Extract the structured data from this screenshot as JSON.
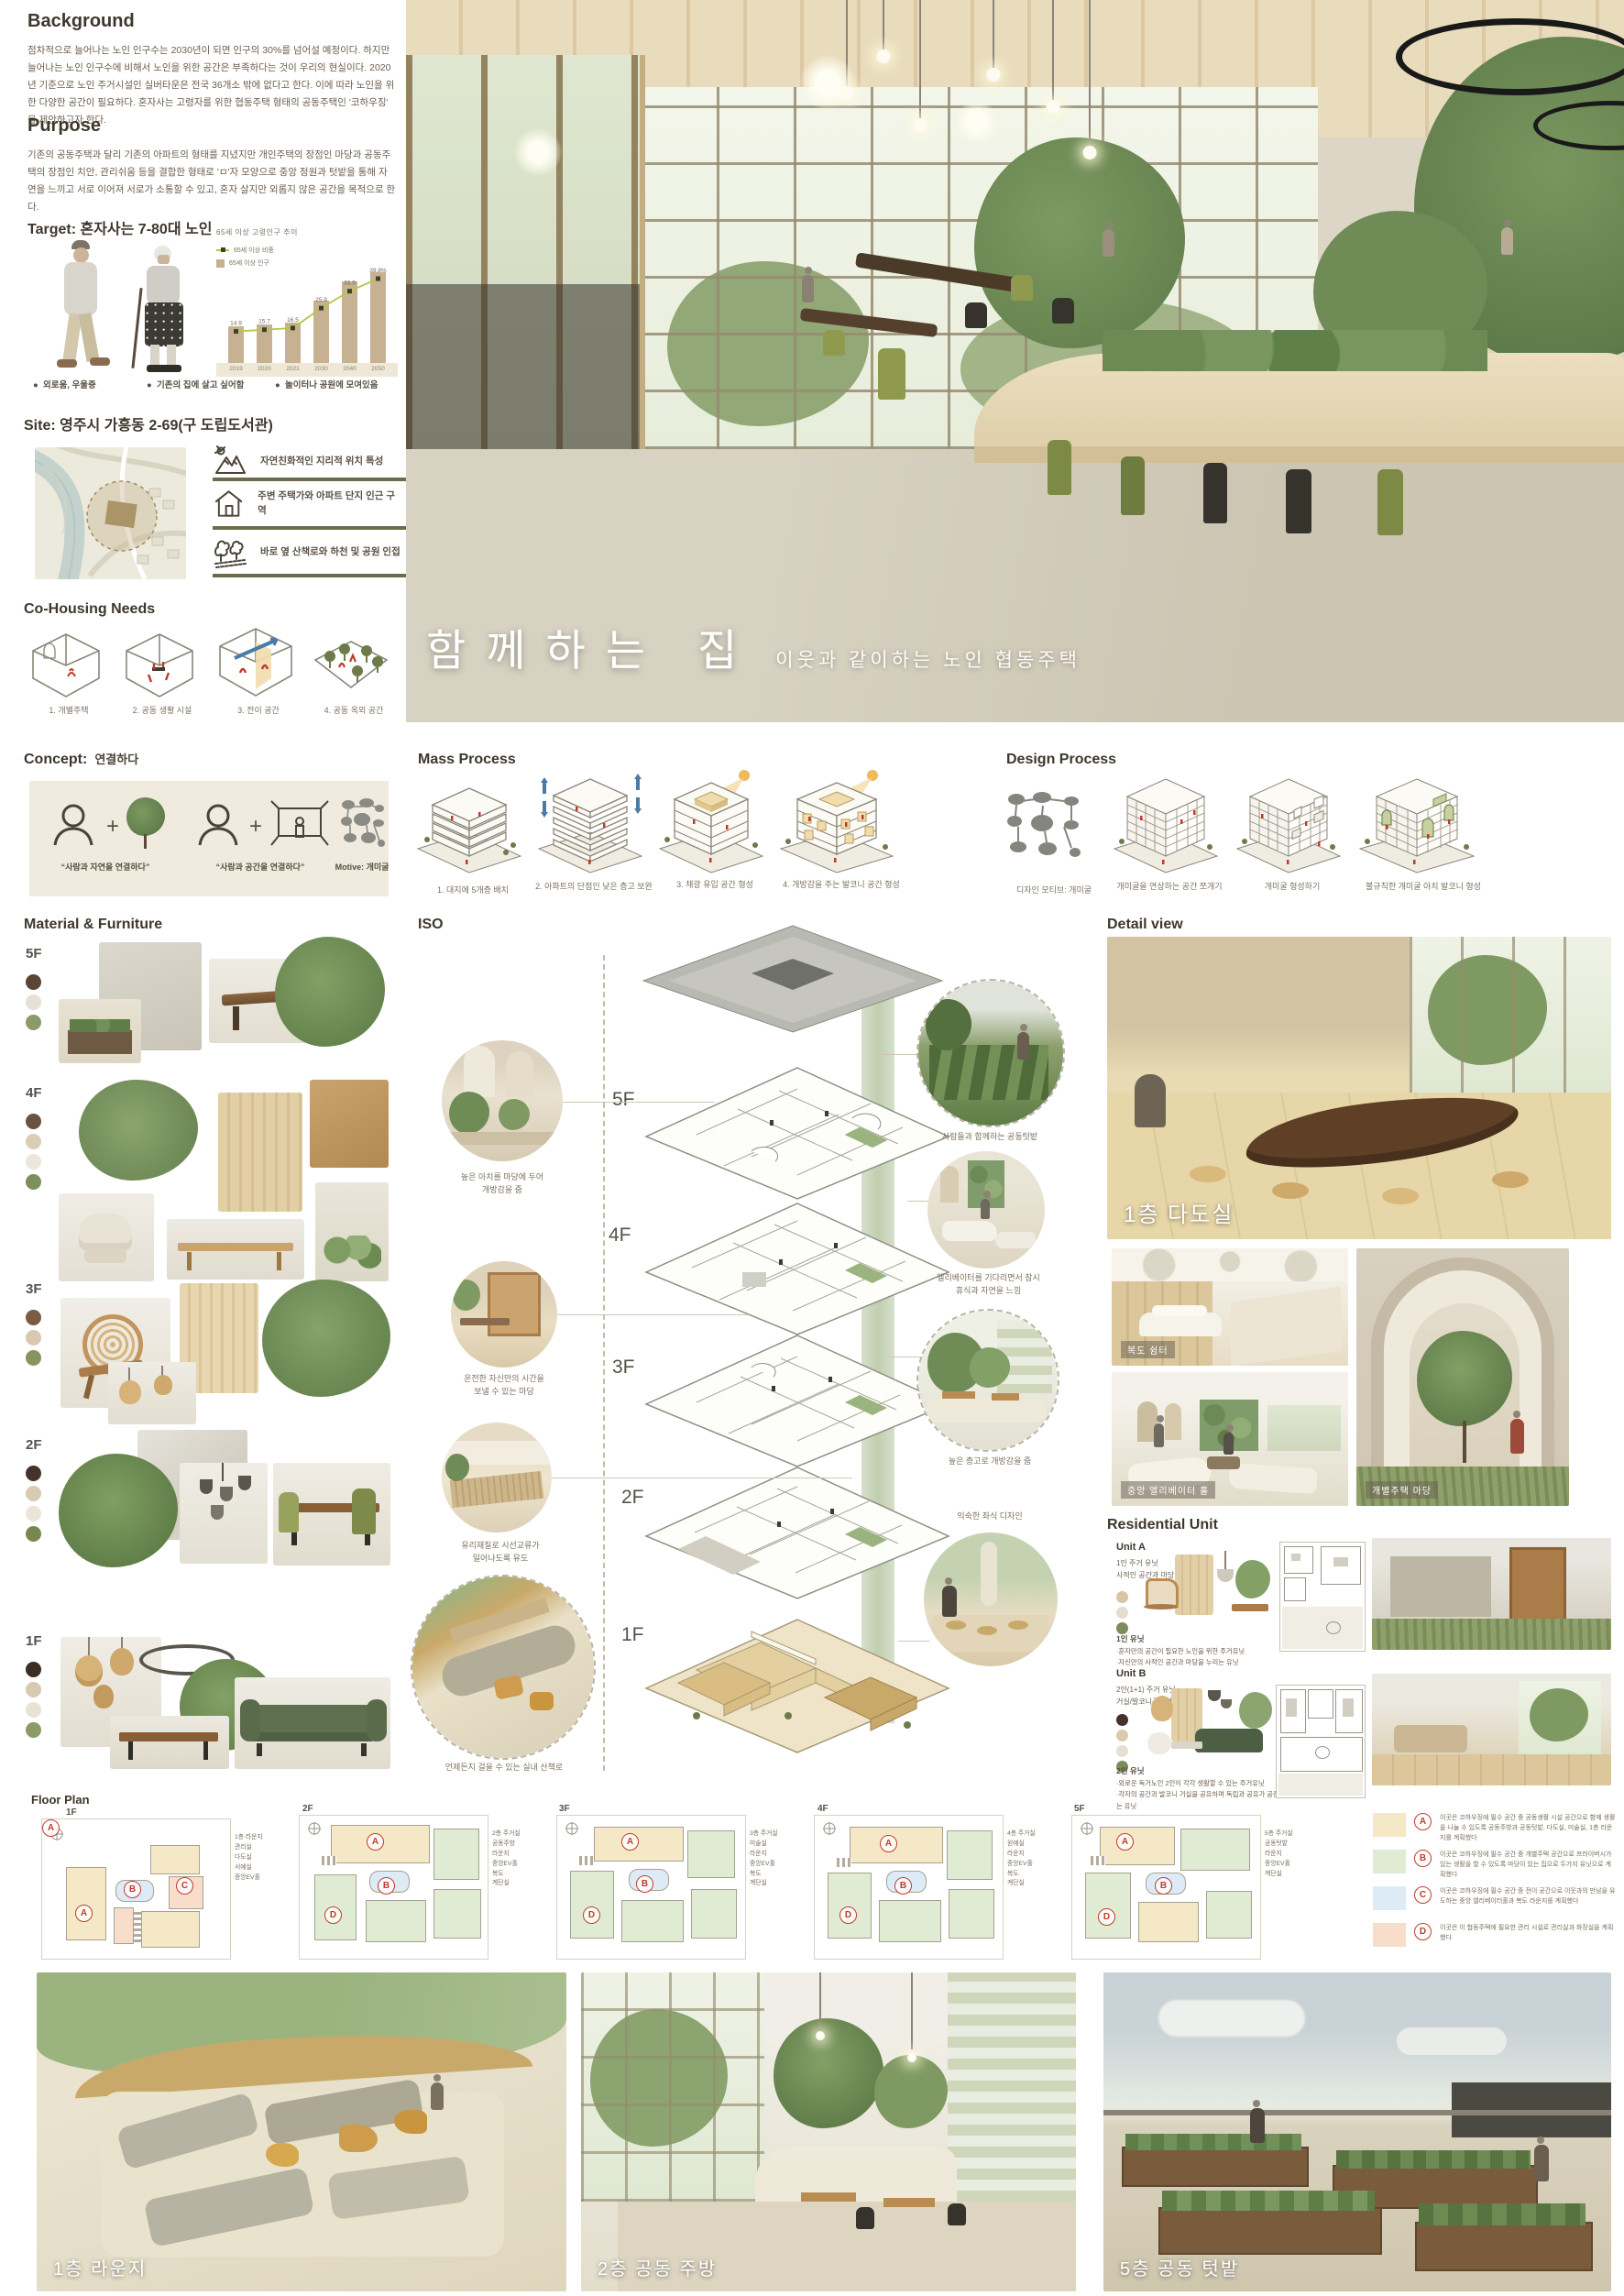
{
  "poster": {
    "title_main": "함께하는 집",
    "title_sub": "이웃과 같이하는 노인 협동주택"
  },
  "background": {
    "heading": "Background",
    "body": "점차적으로 늘어나는 노인 인구수는 2030년이 되면 인구의 30%를 넘어설 예정이다. 하지만 늘어나는 노인 인구수에 비해서 노인을 위한 공간은 부족하다는 것이 우리의 현실이다. 2020년 기준으로 노인 주거시설인 실버타운은 전국 36개소 밖에 없다고 한다. 이에 따라 노인을 위한 다양한 공간이 필요하다. 혼자사는 고령자를 위한 협동주택 형태의 공동주택인 '코하우징' 을 제안하고자 한다."
  },
  "purpose": {
    "heading": "Purpose",
    "body": "기존의 공동주택과 달리 기존의 아파트의 형태를 지녔지만 개인주택의 장점인 마당과 공동주택의 장점인 치안, 관리쉬움 등을 결합한 형태로 'ㅁ'자 모양으로 중앙 정원과 텃밭을 통해 자연을 느끼고 서로 이어져 서로가 소통할 수 있고, 혼자 살지만 외롭지 않은 공간을 목적으로 한다."
  },
  "target": {
    "heading": "Target: 혼자사는 7-80대 노인",
    "bullets": [
      "외로움, 우울증",
      "기존의 집에 살고 싶어함",
      "놀이터나 공원에 모여있음"
    ]
  },
  "chart_data": {
    "type": "bar",
    "title": "65세 이상 고령인구 추이",
    "categories": [
      "2019",
      "2020",
      "2021",
      "2030",
      "2040",
      "2050"
    ],
    "series": [
      {
        "name": "65세 이상 비중",
        "type": "line",
        "values": [
          14.9,
          15.7,
          16.5,
          25.9,
          33.9,
          39.8
        ],
        "point_labels": [
          "14.9",
          "15.7",
          "16.5",
          "25.9",
          "33.9",
          "39.8%"
        ]
      },
      {
        "name": "65세 이상 인구",
        "type": "bar",
        "values": [
          770,
          810,
          850,
          1300,
          1720,
          1900
        ]
      }
    ],
    "xlabel": "",
    "ylabel": "",
    "ylim_line": [
      0,
      45
    ],
    "ylim_bar": [
      0,
      2000
    ],
    "grid": false,
    "legend_position": "top-left"
  },
  "site": {
    "heading": "Site: 영주시 가흥동 2-69(구 도립도서관)",
    "features": [
      {
        "icon": "mountain-icon",
        "text": "자연친화적인 지리적 위치 특성"
      },
      {
        "icon": "house-icon",
        "text": "주변 주택가와 아파트 단지 인근 구역"
      },
      {
        "icon": "trees-icon",
        "text": "바로 옆 산책로와 하천 및 공원 인접"
      }
    ]
  },
  "cohousing": {
    "heading": "Co-Housing Needs",
    "items": [
      "1.  개별주택",
      "2. 공동 생활 시설",
      "3. 전이 공간",
      "4. 공동 옥외 공간"
    ]
  },
  "concept": {
    "heading": "Concept:",
    "keyword": "연결하다",
    "captions": [
      "“사람과 자연을 연결하다”",
      "“사람과 공간을 연결하다”",
      "Motive: 개미굴"
    ]
  },
  "mass_process": {
    "heading": "Mass Process",
    "steps": [
      "1.  대지에 5개층 배치",
      "2. 아파트의 단점인 낮은 층고 보완",
      "3. 채광 유입 공간 형성",
      "4. 개방감을 주는 발코니 공간 형성"
    ]
  },
  "design_process": {
    "heading": "Design Process",
    "steps": [
      "디자인 모티브: 개미굴",
      "개미굴을 연상하는 공간 쪼개기",
      "개미굴 형성하기",
      "불규칙한 개미굴 아치 발코니 형성"
    ]
  },
  "material": {
    "heading": "Material & Furniture",
    "floors": [
      {
        "label": "5F",
        "swatches": [
          "#5a4534",
          "#e6e1d6",
          "#8a9a68"
        ]
      },
      {
        "label": "4F",
        "swatches": [
          "#6a5140",
          "#dccdb6",
          "#ece7dc",
          "#7d8f5c"
        ]
      },
      {
        "label": "3F",
        "swatches": [
          "#7a5c42",
          "#d9c9b0",
          "#86945e"
        ]
      },
      {
        "label": "2F",
        "swatches": [
          "#43332a",
          "#d9cab2",
          "#ebe5d8",
          "#77884f"
        ]
      },
      {
        "label": "1F",
        "swatches": [
          "#3c2d24",
          "#d8c9b1",
          "#e9e3d6",
          "#8b9a66"
        ]
      }
    ]
  },
  "iso": {
    "heading": "ISO",
    "floor_labels": [
      "5F",
      "4F",
      "3F",
      "2F",
      "1F"
    ],
    "left_callouts": [
      "높은 아치를 마당에 두어\n개방감을 줌",
      "온전한 자신만의 시간을\n보낼 수 있는 마당",
      "유리재질로 시선교류가\n일어나도록 유도",
      "언제든지 걸을 수 있는 실내 산책로"
    ],
    "right_callouts": [
      "사람들과 함께하는 공동텃밭",
      "엘리베이터를 기다리면서 잠시\n휴식과 자연을 느낌",
      "높은 층고로 개방감을 줌",
      "익숙한 좌식 디자인"
    ]
  },
  "detail": {
    "heading": "Detail view",
    "labels": [
      "1층 다도실",
      "복도 쉼터",
      "중앙 엘리베이터 홀",
      "개별주택 마당"
    ]
  },
  "residential": {
    "heading": "Residential Unit",
    "units": [
      {
        "name": "Unit A",
        "type": "1인 주거 유닛\n사적인 공간과 마당이 있는 유형",
        "swatches": [
          "#d8c5a8",
          "#e4ddd0",
          "#7c8c5a"
        ],
        "sub": "1인 유닛",
        "notes": "·혼자만의 공간이 필요한 노인을 위한 주거유닛\n·자신만의 사적인 공간과 마당을 누리는 유닛"
      },
      {
        "name": "Unit B",
        "type": "2인(1+1) 주거 유닛\n거실/발코니공유형",
        "swatches": [
          "#46322a",
          "#dcc9ac",
          "#e6e0d4",
          "#7c8c5a"
        ],
        "sub": "2인 유닛",
        "notes": "·외로운 독거노인 2인이 각각 생활할 수 있는 주거유닛\n·각자의 공간과 발코니 거실을 공유하며 독립과 공유가 공존하는 유닛"
      }
    ]
  },
  "floor_plan": {
    "heading": "Floor Plan",
    "plans": [
      {
        "label": "1F",
        "caption": "1층 라운지\n관리실\n다도실\n서예실\n중앙EV홀",
        "badges": [
          "A",
          "B",
          "C"
        ]
      },
      {
        "label": "2F",
        "caption": "2층 주거실\n공동주방\n라운지\n중앙EV홀\n복도\n계단실",
        "badges": [
          "A",
          "B",
          "D"
        ]
      },
      {
        "label": "3F",
        "caption": "3층 주거실\n미술실\n라운지\n중앙EV홀\n복도\n계단실",
        "badges": [
          "A",
          "B",
          "D"
        ]
      },
      {
        "label": "4F",
        "caption": "4층 주거실\n원예실\n라운지\n중앙EV홀\n복도\n계단실",
        "badges": [
          "A",
          "B",
          "D"
        ]
      },
      {
        "label": "5F",
        "caption": "5층 주거실\n공동텃밭\n라운지\n중앙EV홀\n계단실",
        "badges": [
          "A",
          "B",
          "D"
        ]
      }
    ],
    "legend": [
      {
        "key": "A",
        "color": "#f4e8c6",
        "text": "이곳은 코하우징에 필수 공간 중 공동생활 시설 공간으로 함께 생활을 나눌 수 있도록 공동주방과 공동텃밭, 다도실, 미술실, 1층 라운지를 계획했다"
      },
      {
        "key": "B",
        "color": "#dfecd3",
        "text": "이곳은 코하우징에 필수 공간 중 개별주택 공간으로 프라이버시가 있는 생활을 할 수 있도록 마당이 있는 집으로 두가지 유닛으로 계획했다"
      },
      {
        "key": "C",
        "color": "#dcebf6",
        "text": "이곳은 코하우징에 필수 공간 중 전이 공간으로 이웃과의 만남을 유도하는 중앙 엘리베이터홀과 복도 라운지를 계획했다"
      },
      {
        "key": "D",
        "color": "#f7ddca",
        "text": "이곳은 이 협동주택에 필요한 관리 시설로 관리실과 화장실을 계획했다"
      }
    ]
  },
  "bottom": {
    "labels": [
      "1층 라운지",
      "2층 공동 주방",
      "5층 공동 텃밭"
    ]
  }
}
